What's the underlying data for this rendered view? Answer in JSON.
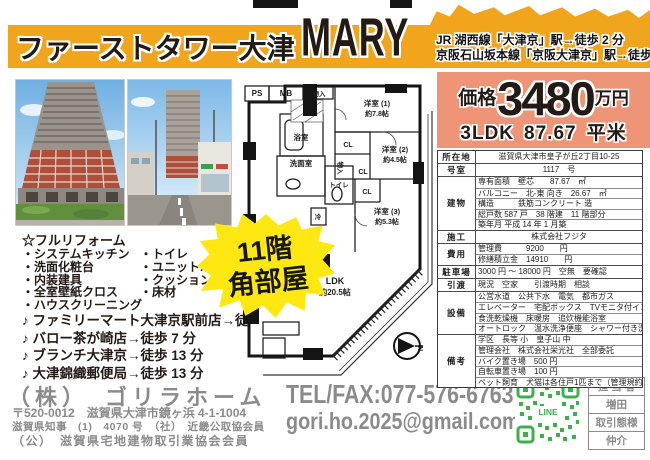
{
  "colors": {
    "header_yellow": "#f1a51c",
    "price_salmon": "#ee9577",
    "badge_yellow": "#ffe712",
    "qr_green": "#3faf4e",
    "footer_grey": "#8b8b8b",
    "ink": "#231a15"
  },
  "header": {
    "title_jp": "ファーストタワー大津",
    "title_en": "MARY",
    "access_line1": "JR 湖西線「大津京」駅→徒歩 2 分",
    "access_line2": "京阪石山坂本線「京阪大津京」駅→徒歩 4 分"
  },
  "price": {
    "label": "価格",
    "amount": "3480",
    "unit": "万円",
    "layout": "3LDK",
    "area": "87.67",
    "area_unit": "平米"
  },
  "badge": {
    "line1": "11階",
    "line2": "角部屋"
  },
  "features": {
    "title": "☆フルリフォーム",
    "rows": [
      {
        "left": "・システムキッチン",
        "right": "・トイレ"
      },
      {
        "left": "・洗面化粧台",
        "right": "・ユニットバス"
      },
      {
        "left": "・内装建具",
        "right": "・クッションフロア"
      },
      {
        "left": "・全室壁紙クロス",
        "right": "・床材"
      },
      {
        "left": "・ハウスクリーニング",
        "right": ""
      }
    ],
    "nearby": [
      "♪ ファミリーマート大津京駅前店→徒歩 1 分",
      "♪ バロー茶が崎店→徒歩 7 分",
      "♪ ブランチ大津京→徒歩 13 分",
      "♪ 大津錦織郵便局→徒歩 13 分"
    ]
  },
  "floorplan": {
    "ps": "PS",
    "mb": "MB",
    "storage_top": "物入",
    "room1": "洋室 (1)",
    "room1_size": "約7.8帖",
    "bath": "浴室",
    "washroom": "洗面室",
    "cl1": "CL",
    "storage_mid": "物入",
    "cl2": "CL",
    "room2": "洋室 (2)",
    "room2_size": "約4.5帖",
    "toilet": "トイレ",
    "fridge": "冷",
    "cl3": "CL",
    "room3": "洋室 (3)",
    "room3_size": "約5.3帖",
    "ldk": "LDK",
    "ldk_size": "約20.5帖",
    "compass": "N"
  },
  "details": {
    "rows": [
      {
        "label": "所在地",
        "lines": [
          "滋賀県大津市皇子が丘2丁目10-25"
        ]
      },
      {
        "label": "号室",
        "lines": [
          "1117　号"
        ]
      },
      {
        "label": "建物",
        "lines": [
          "専有面積　壁芯　　87.67　㎡",
          "バルコニー　北-東 向き　26.67　㎡",
          "構造　　　鉄筋コンクリート 造",
          "総戸数 587 戸　38 階建　11 階部分",
          "築年月 平成 14 年 1 月築"
        ]
      },
      {
        "label": "施工",
        "lines": [
          "株式会社フジタ"
        ]
      },
      {
        "label": "費用",
        "lines": [
          "管理費　　　9200　　円",
          "修繕積立金　14910　　円"
        ]
      },
      {
        "label": "駐車場",
        "lines": [
          "3000 円 ～ 18000 円　空無　要確認"
        ]
      },
      {
        "label": "引渡",
        "lines": [
          "現況　空家　　引渡時期　相談"
        ]
      },
      {
        "label": "設備",
        "lines": [
          "公営水道　公共下水　電気　都市ガス",
          "エレベーター　宅配ボックス　TVモニタ付インターホン",
          "食洗乾燥機　床暖房　追炊機能浴室",
          "オートロック　温水洗浄便座　シャワー付き洗面台"
        ]
      },
      {
        "label": "備考",
        "lines": [
          "学区　長等 小　皇子山 中",
          "管理会社　株式会社栄光社　全部委託",
          "バイク置き場　500 円",
          "自転車置き場　100 円",
          "ペット飼育　犬猫は各住戸1匹まで（管理規約参照）"
        ]
      }
    ]
  },
  "footer": {
    "company": "（株）　ゴリラホーム",
    "address": "〒520-0012　滋賀県大津市鏡ヶ浜 4-1-1004",
    "license1": "滋賀県知事　(1)　4070 号　（社）　近畿公取協会員",
    "license2": "（公）　滋賀県宅地建物取引業協会会員",
    "tel": "TEL/FAX:077-576-6763",
    "email": "gori.ho.2025@gmail.com",
    "qr_label": "LINE",
    "agent": {
      "label1": "担 当 者",
      "name": "増田",
      "label2": "取引態様",
      "type": "仲介"
    }
  }
}
